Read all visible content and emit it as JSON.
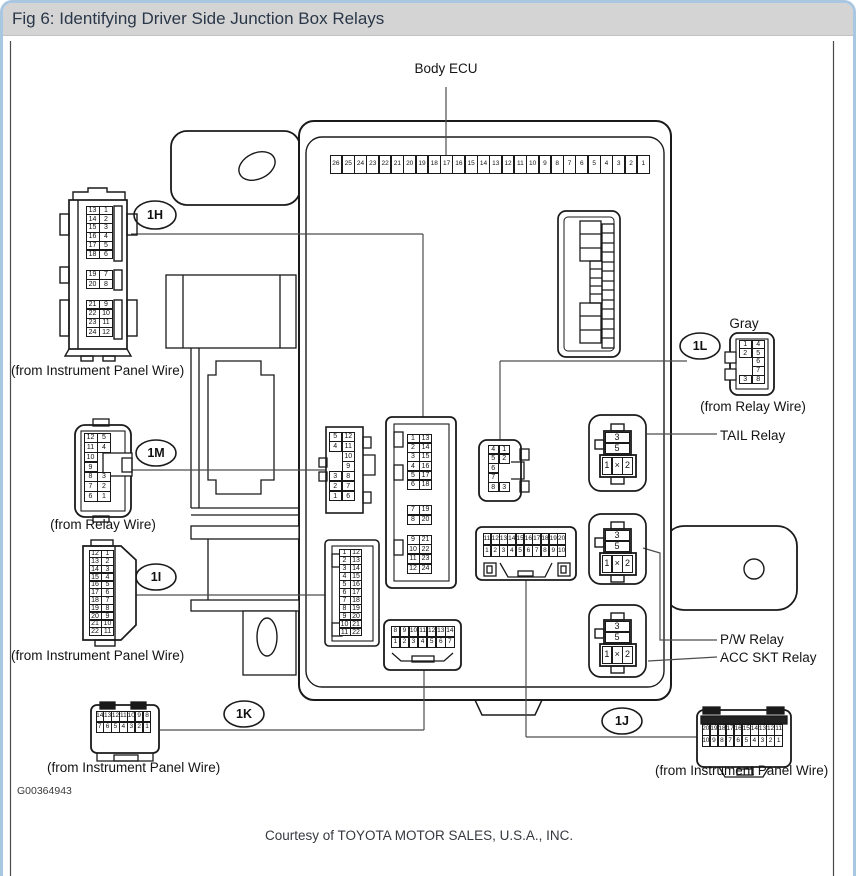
{
  "window": {
    "title": "Fig 6: Identifying Driver Side Junction Box Relays"
  },
  "labels": {
    "body_ecu": "Body ECU",
    "gray": "Gray",
    "tail_relay": "TAIL Relay",
    "pw_relay": "P/W Relay",
    "acc_skt_relay": "ACC SKT Relay",
    "from_instrument_panel_wire": "(from Instrument Panel Wire)",
    "from_relay_wire": "(from Relay Wire)"
  },
  "connector_ids": {
    "h": "1H",
    "m": "1M",
    "i": "1I",
    "k": "1K",
    "l": "1L",
    "j": "1J"
  },
  "footer": {
    "figure_code": "G00364943",
    "courtesy": "Courtesy of TOYOTA MOTOR SALES, U.S.A., INC."
  },
  "grids": {
    "ecu_strip": [
      [
        "26",
        "25",
        "24",
        "23",
        "22",
        "21",
        "20",
        "19",
        "18",
        "17",
        "16",
        "15",
        "14",
        "13",
        "12",
        "11",
        "10",
        "9",
        "8",
        "7",
        "6",
        "5",
        "4",
        "3",
        "2",
        "1"
      ]
    ],
    "h_plug_g1": [
      [
        "13",
        "1"
      ],
      [
        "14",
        "2"
      ],
      [
        "15",
        "3"
      ],
      [
        "16",
        "4"
      ],
      [
        "17",
        "5"
      ],
      [
        "18",
        "6"
      ]
    ],
    "h_plug_g2": [
      [
        "19",
        "7"
      ],
      [
        "20",
        "8"
      ]
    ],
    "h_plug_g3": [
      [
        "21",
        "9"
      ],
      [
        "22",
        "10"
      ],
      [
        "23",
        "11"
      ],
      [
        "24",
        "12"
      ]
    ],
    "m_plug": [
      [
        "12",
        "5"
      ],
      [
        "11",
        "4"
      ],
      [
        "10",
        ""
      ],
      [
        "9",
        ""
      ],
      [
        "8",
        "3"
      ],
      [
        "7",
        "2"
      ],
      [
        "6",
        "1"
      ]
    ],
    "i_plug": [
      [
        "12",
        "1"
      ],
      [
        "13",
        "2"
      ],
      [
        "14",
        "3"
      ],
      [
        "15",
        "4"
      ],
      [
        "16",
        "5"
      ],
      [
        "17",
        "6"
      ],
      [
        "18",
        "7"
      ],
      [
        "19",
        "8"
      ],
      [
        "20",
        "9"
      ],
      [
        "21",
        "10"
      ],
      [
        "22",
        "11"
      ]
    ],
    "k_plug": [
      [
        "14",
        "13",
        "12",
        "11",
        "10",
        "9",
        "8"
      ],
      [
        "7",
        "6",
        "5",
        "4",
        "3",
        "2",
        "1"
      ]
    ],
    "gray_plug": [
      [
        "1",
        "4"
      ],
      [
        "2",
        "5"
      ],
      [
        "",
        "6"
      ],
      [
        "",
        "7"
      ],
      [
        "3",
        "8"
      ]
    ],
    "j_plug": [
      [
        "20",
        "19",
        "18",
        "17",
        "16",
        "15",
        "14",
        "13",
        "12",
        "11"
      ],
      [
        "10",
        "9",
        "8",
        "7",
        "6",
        "5",
        "4",
        "3",
        "2",
        "1"
      ]
    ],
    "m_receptacle": [
      [
        "5",
        "12"
      ],
      [
        "4",
        "11"
      ],
      [
        "",
        "10"
      ],
      [
        "",
        "9"
      ],
      [
        "3",
        "8"
      ],
      [
        "2",
        "7"
      ],
      [
        "1",
        "6"
      ]
    ],
    "h_rec_g1": [
      [
        "1",
        "13"
      ],
      [
        "2",
        "14"
      ],
      [
        "3",
        "15"
      ],
      [
        "4",
        "16"
      ],
      [
        "5",
        "17"
      ],
      [
        "6",
        "18"
      ]
    ],
    "h_rec_g2": [
      [
        "7",
        "19"
      ],
      [
        "8",
        "20"
      ]
    ],
    "h_rec_g3": [
      [
        "9",
        "21"
      ],
      [
        "10",
        "22"
      ],
      [
        "11",
        "23"
      ],
      [
        "12",
        "24"
      ]
    ],
    "i_receptacle": [
      [
        "1",
        "12"
      ],
      [
        "2",
        "13"
      ],
      [
        "3",
        "14"
      ],
      [
        "4",
        "15"
      ],
      [
        "5",
        "16"
      ],
      [
        "6",
        "17"
      ],
      [
        "7",
        "18"
      ],
      [
        "8",
        "19"
      ],
      [
        "9",
        "20"
      ],
      [
        "10",
        "21"
      ],
      [
        "11",
        "22"
      ]
    ],
    "l_receptacle": [
      [
        "4",
        "1"
      ],
      [
        "5",
        "2"
      ],
      [
        "6",
        ""
      ],
      [
        "7",
        ""
      ],
      [
        "8",
        "3"
      ]
    ],
    "j_receptacle": [
      [
        "11",
        "12",
        "13",
        "14",
        "15",
        "16",
        "17",
        "18",
        "19",
        "20"
      ],
      [
        "1",
        "2",
        "3",
        "4",
        "5",
        "6",
        "7",
        "8",
        "9",
        "10"
      ]
    ],
    "k_receptacle": [
      [
        "8",
        "9",
        "10",
        "11",
        "12",
        "13",
        "14"
      ],
      [
        "1",
        "2",
        "3",
        "4",
        "5",
        "6",
        "7"
      ]
    ]
  },
  "relay_pins": {
    "top": [
      [
        "3"
      ],
      [
        "5"
      ]
    ],
    "bottom": [
      [
        "1",
        "×",
        "2"
      ]
    ]
  }
}
